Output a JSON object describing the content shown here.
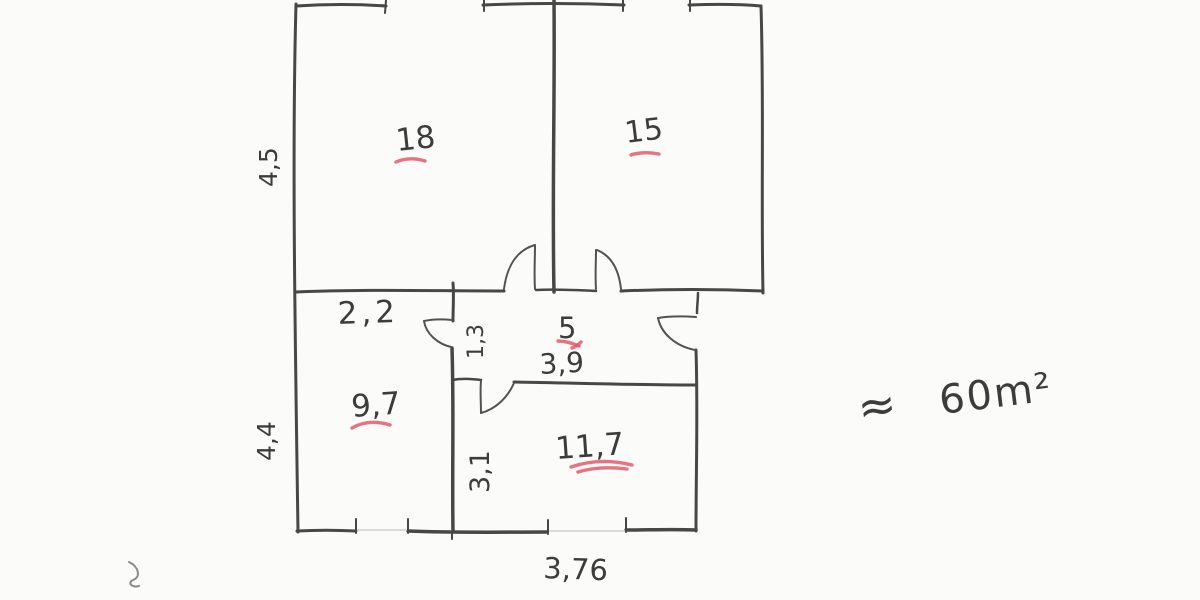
{
  "floor_plan": {
    "room_areas": {
      "top_left": "18",
      "top_right": "15",
      "bottom_left": "9,7",
      "bottom_right": "11,7",
      "hallway": "5"
    },
    "dimensions": {
      "upper_left_height": "4,5",
      "lower_left_height": "4,4",
      "left_room_width": "2,2",
      "corridor_width": "1,3",
      "hallway_width": "3,9",
      "lower_right_room_height": "3,1",
      "bottom_room_width": "3,76"
    },
    "total_area": {
      "approx_symbol": "≈",
      "value": "60m²"
    },
    "colors": {
      "pencil": "#474747",
      "red_marker": "#e05a6b",
      "paper": "#fbfbf9"
    }
  }
}
